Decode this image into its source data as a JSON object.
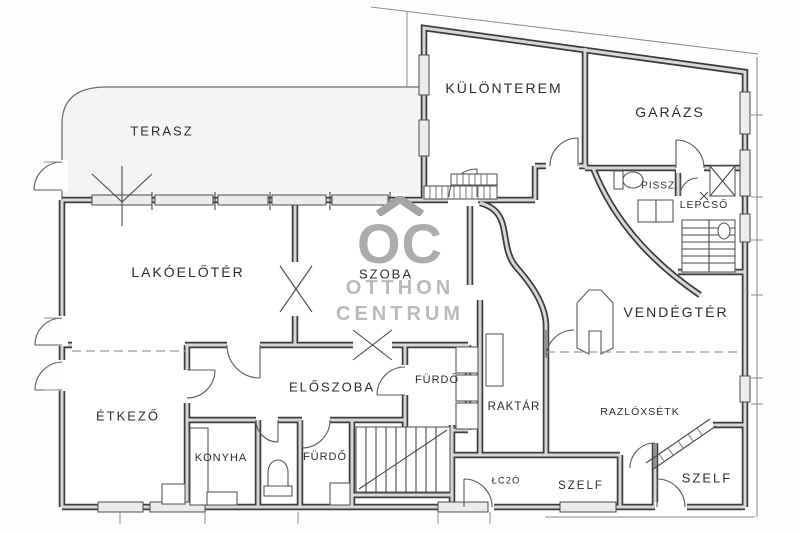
{
  "watermark": {
    "logo": "OC",
    "line1": "OTTHON",
    "line2": "CENTRUM"
  },
  "rooms": {
    "terasz": "TERASZ",
    "kulonterem": "KÜLÖNTEREM",
    "garazs": "GARÁZS",
    "pissz": "PISSZ.",
    "lepcso": "LEPCSŐ",
    "lakoeloter": "LAKÓELŐTÉR",
    "szoba": "SZOBA",
    "vendegter": "VENDÉGTÉR",
    "etkezo": "ÉTKEZŐ",
    "eloszoba": "ELŐSZOBA",
    "furdo_felso": "FÜRDŐ",
    "raktar": "RAKTÁR",
    "razloxsetk": "RAZLÓXSÉTK",
    "konyha": "KONYHA",
    "furdo_also": "FÜRDŐ",
    "lc2o": "ŁC2Ó",
    "szelf_kozep": "SZELF",
    "szelf_jobb": "SZELF"
  },
  "colors": {
    "line": "#3d3d3d",
    "wall_fill": "#d7d7d7",
    "terrace_fill": "#f4f4f4",
    "watermark": "#a8a8a8"
  }
}
